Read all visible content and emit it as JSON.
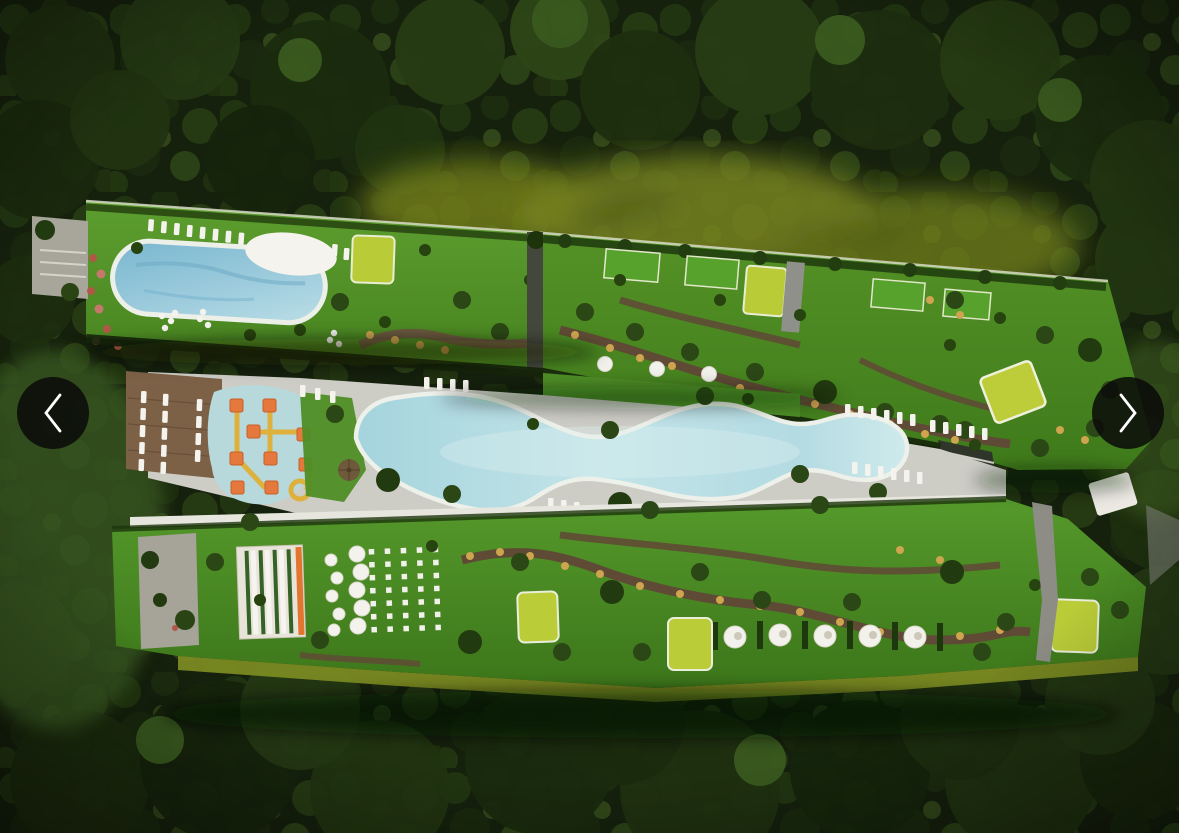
{
  "carousel": {
    "prev_label": "Previous photo",
    "next_label": "Next photo",
    "prev_icon": "chevron-left",
    "next_icon": "chevron-right",
    "button_color": "#0a0a0a",
    "chevron_color": "#ffffff"
  },
  "image": {
    "alt": "Aerial 3D render of a tropical resort residence: two long green-roof amenity buildings flanking a free-form lagoon pool, rooftop pool with white sundeck and loungers, orange kids water playground, event lawn with dining tables and round daybed cabanas, lime-green yoga decks, winding garden paths, all surrounded by dense jungle and an olive pond",
    "palette": {
      "forest_dark": "#15200d",
      "canopy_green": "#2a4014",
      "lawn_green": "#54962a",
      "lime_deck": "#b9cb37",
      "pool_water": "#aed8e2",
      "deck_gray": "#cdcdc6",
      "mulch_brown": "#5f4b35",
      "play_orange": "#e5783c",
      "play_yellow": "#ddb13c",
      "pond_olive": "#76811d",
      "wood_deck": "#7d6147"
    }
  }
}
